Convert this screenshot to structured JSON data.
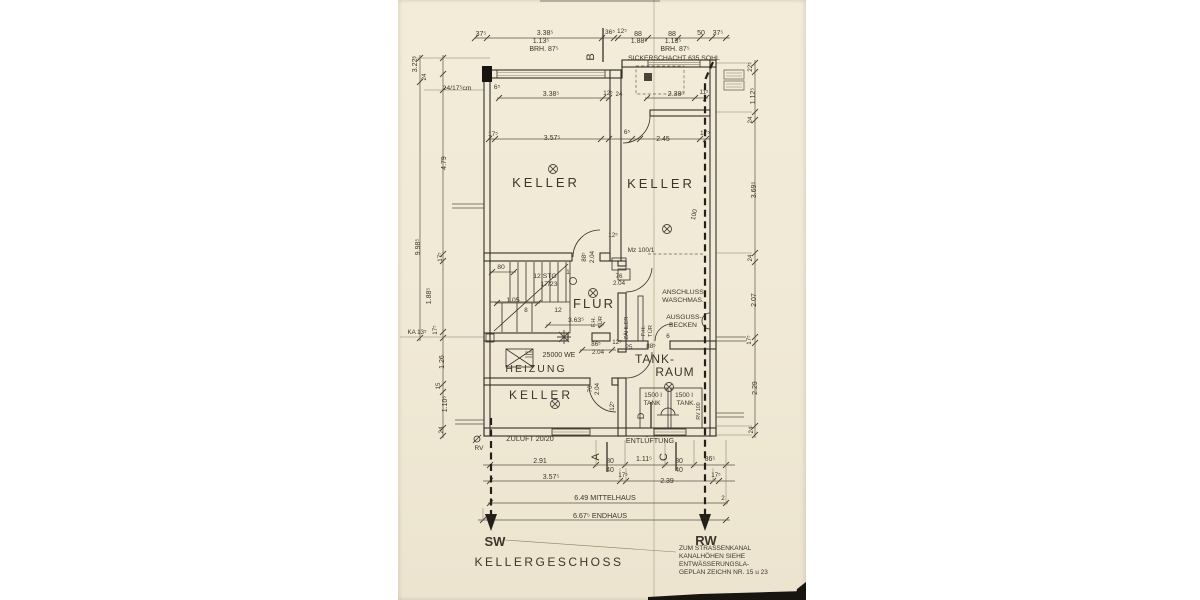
{
  "drawing": {
    "title": "KELLERGESCHOSS",
    "kind": "scanned basement floor plan blueprint"
  },
  "rooms": [
    "KELLER",
    "KELLER",
    "FLUR",
    "HEIZUNG",
    "KELLER",
    "TANK-RAUM"
  ],
  "pipes": {
    "left": "SW",
    "right": "RW"
  },
  "sections": [
    "A",
    "B",
    "C",
    "D"
  ],
  "note": [
    "ZUM STRASSENKANAL",
    "KANALHÖHEN SIEHE",
    "ENTWÄSSERUNGSLA-",
    "GEPLAN ZEICHN NR. 15 u 23"
  ],
  "colors": {
    "paper": "#f0e9d6",
    "ink": "#3b362b",
    "wall": "#35302a",
    "dim": "#5c5546"
  },
  "labels": [
    {
      "t": "37⁵",
      "x": 481,
      "y": 36,
      "s": 7
    },
    {
      "t": "3.38⁵",
      "x": 545,
      "y": 35,
      "s": 7
    },
    {
      "t": "1.13⁵",
      "x": 541,
      "y": 43,
      "s": 7
    },
    {
      "t": "BRH. 87⁵",
      "x": 544,
      "y": 51,
      "s": 7
    },
    {
      "t": "36⁵",
      "x": 610,
      "y": 34,
      "s": 6.5
    },
    {
      "t": "12⁵",
      "x": 622,
      "y": 33,
      "s": 6.5
    },
    {
      "t": "88",
      "x": 638,
      "y": 36,
      "s": 7
    },
    {
      "t": "1.88⁵",
      "x": 639,
      "y": 43,
      "s": 7
    },
    {
      "t": "88",
      "x": 672,
      "y": 36,
      "s": 7
    },
    {
      "t": "1.13⁵",
      "x": 673,
      "y": 43,
      "s": 7
    },
    {
      "t": "BRH. 87⁵",
      "x": 675,
      "y": 51,
      "s": 7
    },
    {
      "t": "50",
      "x": 701,
      "y": 35,
      "s": 7
    },
    {
      "t": "37⁵",
      "x": 718,
      "y": 35,
      "s": 7
    },
    {
      "t": "SICKERSCHACHT 635 SOHL",
      "x": 674,
      "y": 60,
      "s": 6.8,
      "n": "label-sickerschacht"
    },
    {
      "t": "B",
      "x": 594,
      "y": 57,
      "s": 11,
      "r": -90,
      "n": "section-mark-b"
    },
    {
      "t": "3.22⁵",
      "x": 417,
      "y": 64,
      "s": 7,
      "r": -90
    },
    {
      "t": "24",
      "x": 426,
      "y": 77,
      "s": 6.2,
      "r": -90
    },
    {
      "t": "24/17⁵cm",
      "x": 457,
      "y": 90,
      "s": 6.8
    },
    {
      "t": "6⁵",
      "x": 497,
      "y": 89,
      "s": 6.5
    },
    {
      "t": "4.79",
      "x": 446,
      "y": 163,
      "s": 7,
      "r": -90
    },
    {
      "t": "9.98⁵",
      "x": 420,
      "y": 247,
      "s": 7,
      "r": -90
    },
    {
      "t": "17⁵",
      "x": 442,
      "y": 257,
      "s": 6.2,
      "r": -90
    },
    {
      "t": "1.88⁵",
      "x": 431,
      "y": 296,
      "s": 7,
      "r": -90
    },
    {
      "t": "17⁵",
      "x": 437,
      "y": 330,
      "s": 6.2,
      "r": -90
    },
    {
      "t": "KA 13⁵",
      "x": 417,
      "y": 334,
      "s": 6.2
    },
    {
      "t": "1.26",
      "x": 444,
      "y": 362,
      "s": 7,
      "r": -90
    },
    {
      "t": "15",
      "x": 440,
      "y": 386,
      "s": 6.2,
      "r": -90
    },
    {
      "t": "1.10⁵",
      "x": 447,
      "y": 404,
      "s": 7,
      "r": -90
    },
    {
      "t": "24",
      "x": 443,
      "y": 430,
      "s": 6.2,
      "r": -90
    },
    {
      "t": "22⁵",
      "x": 752,
      "y": 67,
      "s": 6.2,
      "r": -90
    },
    {
      "t": "1.12⁵",
      "x": 755,
      "y": 96,
      "s": 7,
      "r": -90
    },
    {
      "t": "24",
      "x": 752,
      "y": 120,
      "s": 6.2,
      "r": -90
    },
    {
      "t": "3.69⁵",
      "x": 756,
      "y": 190,
      "s": 7,
      "r": -90
    },
    {
      "t": "24",
      "x": 752,
      "y": 258,
      "s": 6.2,
      "r": -90
    },
    {
      "t": "2.07",
      "x": 756,
      "y": 300,
      "s": 7,
      "r": -90
    },
    {
      "t": "17⁵",
      "x": 751,
      "y": 340,
      "s": 6.2,
      "r": -90
    },
    {
      "t": "2.29",
      "x": 757,
      "y": 388,
      "s": 7,
      "r": -90
    },
    {
      "t": "24",
      "x": 753,
      "y": 430,
      "s": 6.2,
      "r": -90
    },
    {
      "t": "3.38⁵",
      "x": 551,
      "y": 96,
      "s": 7
    },
    {
      "t": "12⁵",
      "x": 608,
      "y": 95,
      "s": 6.2
    },
    {
      "t": "24",
      "x": 619,
      "y": 96,
      "s": 6.2
    },
    {
      "t": "2.38⁵",
      "x": 676,
      "y": 96,
      "s": 7
    },
    {
      "t": "11⁵",
      "x": 704,
      "y": 94,
      "s": 6.2
    },
    {
      "t": "17⁵",
      "x": 493,
      "y": 136,
      "s": 6.5
    },
    {
      "t": "3.57⁵",
      "x": 552,
      "y": 140,
      "s": 7
    },
    {
      "t": "6⁵",
      "x": 627,
      "y": 134,
      "s": 6.5
    },
    {
      "t": "2.45",
      "x": 663,
      "y": 141,
      "s": 7
    },
    {
      "t": "17⁵",
      "x": 705,
      "y": 135,
      "s": 6.5
    },
    {
      "t": "KELLER",
      "x": 546,
      "y": 187,
      "s": 13,
      "ls": 3,
      "n": "room-keller-nw"
    },
    {
      "t": "KELLER",
      "x": 661,
      "y": 188,
      "s": 13,
      "ls": 3,
      "n": "room-keller-ne"
    },
    {
      "t": "100",
      "x": 696,
      "y": 215,
      "s": 6.5,
      "r": -78
    },
    {
      "t": "12⁵",
      "x": 613,
      "y": 237,
      "s": 6.2
    },
    {
      "t": "88⁵",
      "x": 586,
      "y": 257,
      "s": 6.2,
      "r": -90
    },
    {
      "t": "2.04",
      "x": 594,
      "y": 257,
      "s": 6.2,
      "r": -90
    },
    {
      "t": "Mz 100/1",
      "x": 641,
      "y": 252,
      "s": 6.5
    },
    {
      "t": "76",
      "x": 619,
      "y": 278,
      "s": 6.2
    },
    {
      "t": "2.04",
      "x": 619,
      "y": 285,
      "s": 6.2
    },
    {
      "t": "80",
      "x": 501,
      "y": 269,
      "s": 6.8
    },
    {
      "t": "12 STG",
      "x": 545,
      "y": 278,
      "s": 6.8
    },
    {
      "t": "17/23",
      "x": 549,
      "y": 286,
      "s": 6.8
    },
    {
      "t": "1",
      "x": 568,
      "y": 274,
      "s": 6.2
    },
    {
      "t": "1.05",
      "x": 513,
      "y": 302,
      "s": 6.8
    },
    {
      "t": "8",
      "x": 526,
      "y": 312,
      "s": 6.2
    },
    {
      "t": "12",
      "x": 558,
      "y": 312,
      "s": 6.8
    },
    {
      "t": "3.63⁵",
      "x": 576,
      "y": 322,
      "s": 6.8
    },
    {
      "t": "FLUR",
      "x": 594,
      "y": 308,
      "s": 13,
      "ls": 2,
      "n": "room-flur"
    },
    {
      "t": "F.H.",
      "x": 595,
      "y": 322,
      "s": 5.8,
      "r": -90
    },
    {
      "t": "TÜR",
      "x": 602,
      "y": 322,
      "s": 5.8,
      "r": -90
    },
    {
      "t": "ZÄHLER",
      "x": 628,
      "y": 328,
      "s": 5.8,
      "r": -90
    },
    {
      "t": "F.H.",
      "x": 645,
      "y": 331,
      "s": 5.8,
      "r": -90
    },
    {
      "t": "TÜR",
      "x": 652,
      "y": 331,
      "s": 5.8,
      "r": -90
    },
    {
      "t": "ANSCHLUSS",
      "x": 683,
      "y": 294,
      "s": 6.8,
      "n": "label-anschluss-waschmaschine"
    },
    {
      "t": "WASCHMAS.",
      "x": 683,
      "y": 302,
      "s": 6.8
    },
    {
      "t": "AUSGUSS-",
      "x": 684,
      "y": 319,
      "s": 6.8,
      "n": "label-ausgussbecken"
    },
    {
      "t": "BECKEN",
      "x": 683,
      "y": 327,
      "s": 6.8
    },
    {
      "t": "6",
      "x": 668,
      "y": 338,
      "s": 6.2
    },
    {
      "t": "86⁵",
      "x": 596,
      "y": 346,
      "s": 6.2
    },
    {
      "t": "2.04",
      "x": 598,
      "y": 354,
      "s": 6.2
    },
    {
      "t": "12⁵",
      "x": 617,
      "y": 344,
      "s": 6.2
    },
    {
      "t": "25",
      "x": 629,
      "y": 349,
      "s": 6.2
    },
    {
      "t": "88⁵",
      "x": 651,
      "y": 348,
      "s": 6.2
    },
    {
      "t": "25000 WE",
      "x": 559,
      "y": 357,
      "s": 7,
      "n": "label-heizung-capacity"
    },
    {
      "t": "HEIZUNG",
      "x": 536,
      "y": 372,
      "s": 10.5,
      "ls": 2,
      "n": "room-heizung"
    },
    {
      "t": "KELLER",
      "x": 541,
      "y": 399,
      "s": 12,
      "ls": 3,
      "n": "room-keller-sw"
    },
    {
      "t": "76",
      "x": 592,
      "y": 389,
      "s": 6.2,
      "r": -90
    },
    {
      "t": "2.04",
      "x": 599,
      "y": 389,
      "s": 6.2,
      "r": -90
    },
    {
      "t": "12⁵",
      "x": 614,
      "y": 406,
      "s": 6.2,
      "r": -90
    },
    {
      "t": "TANK-",
      "x": 655,
      "y": 363,
      "s": 12,
      "ls": 1,
      "n": "room-tankraum-line1"
    },
    {
      "t": "RAUM",
      "x": 675,
      "y": 376,
      "s": 12,
      "ls": 1,
      "n": "room-tankraum-line2"
    },
    {
      "t": "1500 l",
      "x": 653,
      "y": 397,
      "s": 6.5,
      "n": "label-tank-1"
    },
    {
      "t": "TANK",
      "x": 652,
      "y": 405,
      "s": 6.5
    },
    {
      "t": "1500 l",
      "x": 684,
      "y": 397,
      "s": 6.5,
      "n": "label-tank-2"
    },
    {
      "t": "TANK.",
      "x": 686,
      "y": 405,
      "s": 6.5
    },
    {
      "t": "D",
      "x": 644,
      "y": 416,
      "s": 9,
      "r": -90,
      "n": "section-mark-d"
    },
    {
      "t": "RV 100",
      "x": 700,
      "y": 411,
      "s": 5.2,
      "r": -90
    },
    {
      "t": "RV",
      "x": 479,
      "y": 450,
      "s": 6.5
    },
    {
      "t": "ZULUFT 20/20",
      "x": 530,
      "y": 441,
      "s": 7.2,
      "n": "label-zuluft"
    },
    {
      "t": "ENTLÜFTUNG",
      "x": 650,
      "y": 443,
      "s": 7.2,
      "n": "label-entlueftung"
    },
    {
      "t": "A",
      "x": 599,
      "y": 457,
      "s": 11,
      "r": -90,
      "n": "section-mark-a"
    },
    {
      "t": "C",
      "x": 667,
      "y": 457,
      "s": 11,
      "r": -90,
      "n": "section-mark-c"
    },
    {
      "t": "2.91",
      "x": 540,
      "y": 463,
      "s": 7
    },
    {
      "t": "80",
      "x": 610,
      "y": 463,
      "s": 7
    },
    {
      "t": "40",
      "x": 610,
      "y": 472,
      "s": 7
    },
    {
      "t": "1.11⁵",
      "x": 644,
      "y": 461,
      "s": 7
    },
    {
      "t": "80",
      "x": 679,
      "y": 463,
      "s": 7
    },
    {
      "t": "40",
      "x": 679,
      "y": 472,
      "s": 7
    },
    {
      "t": "86⁵",
      "x": 710,
      "y": 461,
      "s": 7
    },
    {
      "t": "3.57⁵",
      "x": 551,
      "y": 479,
      "s": 7
    },
    {
      "t": "17⁵",
      "x": 623,
      "y": 477,
      "s": 6.2
    },
    {
      "t": "2.39",
      "x": 667,
      "y": 483,
      "s": 7
    },
    {
      "t": "17⁵",
      "x": 716,
      "y": 477,
      "s": 6.2
    },
    {
      "t": "2",
      "x": 723,
      "y": 500,
      "s": 6.2
    },
    {
      "t": "6.49 MITTELHAUS",
      "x": 605,
      "y": 500,
      "s": 7.2,
      "n": "label-mittelhaus"
    },
    {
      "t": "6.67⁵ ENDHAUS",
      "x": 600,
      "y": 518,
      "s": 7.2,
      "n": "label-endhaus"
    },
    {
      "t": "SW",
      "x": 495,
      "y": 546,
      "s": 13,
      "b": 1,
      "n": "pipe-label-sw"
    },
    {
      "t": "RW",
      "x": 706,
      "y": 545,
      "s": 13,
      "b": 1,
      "n": "pipe-label-rw"
    },
    {
      "t": "KELLERGESCHOSS",
      "x": 549,
      "y": 566,
      "s": 12,
      "ls": 2.5,
      "n": "drawing-title"
    },
    {
      "t": "ZUM STRASSENKANAL",
      "x": 679,
      "y": 550,
      "s": 6.5,
      "a": "start",
      "n": "note-line-1"
    },
    {
      "t": "KANALHÖHEN SIEHE",
      "x": 679,
      "y": 558,
      "s": 6.5,
      "a": "start",
      "n": "note-line-2"
    },
    {
      "t": "ENTWÄSSERUNGSLA-",
      "x": 679,
      "y": 566,
      "s": 6.5,
      "a": "start",
      "n": "note-line-3"
    },
    {
      "t": "GEPLAN ZEICHN NR. 15 u 23",
      "x": 679,
      "y": 574,
      "s": 6.5,
      "a": "start",
      "n": "note-line-4"
    }
  ]
}
